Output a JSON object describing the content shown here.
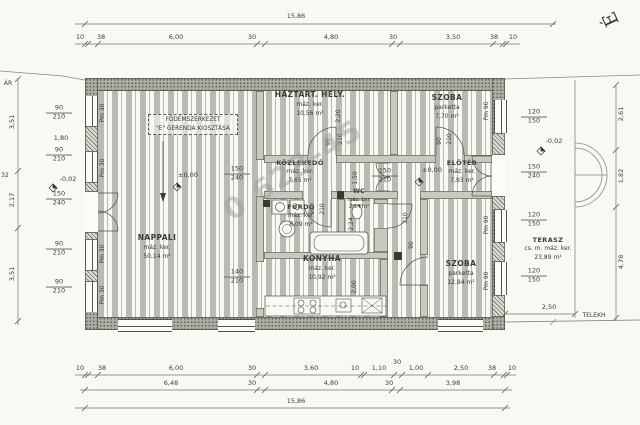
{
  "drawing": {
    "watermark": "0 623-45",
    "north": "É",
    "boundary": {
      "left": "ÁR",
      "right": "TELEKH"
    },
    "note": {
      "line1": "FÖDÉMSZERKEZET",
      "line2": "\"E\" GERENDA KIOSZTÁSA"
    },
    "levels": {
      "zero": "±0,00",
      "minus2": "-0,02"
    },
    "markers": {
      "pm30": "Pm 30",
      "pm90": "Pm 90"
    },
    "rooms": {
      "nappali": {
        "name": "NAPPALI",
        "finish": "máz. ker.",
        "area": "50,14 m²"
      },
      "haztart": {
        "name": "HÁZTART. HELY.",
        "finish": "máz. ker.",
        "area": "10,56 m²"
      },
      "kozlekedo": {
        "name": "KÖZLEKEDŐ",
        "finish": "máz. ker.",
        "area": "7,65 m²"
      },
      "szoba1": {
        "name": "SZOBA",
        "finish": "parketta",
        "area": "7,70 m²"
      },
      "eloter": {
        "name": "ELŐTÉR",
        "finish": "máz. ker.",
        "area": "7,93 m²"
      },
      "furdo": {
        "name": "FÜRDŐ",
        "finish": "máz. ker.",
        "area": "8,09 m²"
      },
      "wc": {
        "name": "WC",
        "finish": "máz. ker.",
        "area": "2,14 m²"
      },
      "konyha": {
        "name": "KONYHA",
        "finish": "máz. ker.",
        "area": "10,92 m²"
      },
      "szoba2": {
        "name": "SZOBA",
        "finish": "parketta",
        "area": "12,84 m²"
      },
      "terasz": {
        "name": "TERASZ",
        "finish": "cs. m. máz. ker.",
        "area": "23,89 m²"
      }
    },
    "dims": {
      "top_total": "15,86",
      "top": [
        "10",
        "38",
        "6,00",
        "30",
        "4,80",
        "30",
        "3,50",
        "38",
        "10"
      ],
      "bottom1": [
        "10",
        "38",
        "6,00",
        "30",
        "3,60",
        "10",
        "1,10",
        "30",
        "1,00",
        "2,50",
        "38",
        "10"
      ],
      "bottom2": [
        "6,48",
        "30",
        "4,80",
        "30",
        "3,98"
      ],
      "bottom_total": "15,86",
      "left": [
        "3,51",
        "2,17",
        "3,51"
      ],
      "left_edge": "32",
      "right": [
        "2,61",
        "1,82",
        "4,78"
      ],
      "terrace_width": "2,50",
      "pier_gap": "1,80",
      "haztart_depth": "2,20",
      "kozlekedo_width": "1,50",
      "wc_depth": "2,24",
      "konyha_depth": "2,00"
    },
    "openings": {
      "w90": "90",
      "h210": "210",
      "w120": "120",
      "h150": "150",
      "w150": "150",
      "h240": "240",
      "w140": "140"
    }
  }
}
